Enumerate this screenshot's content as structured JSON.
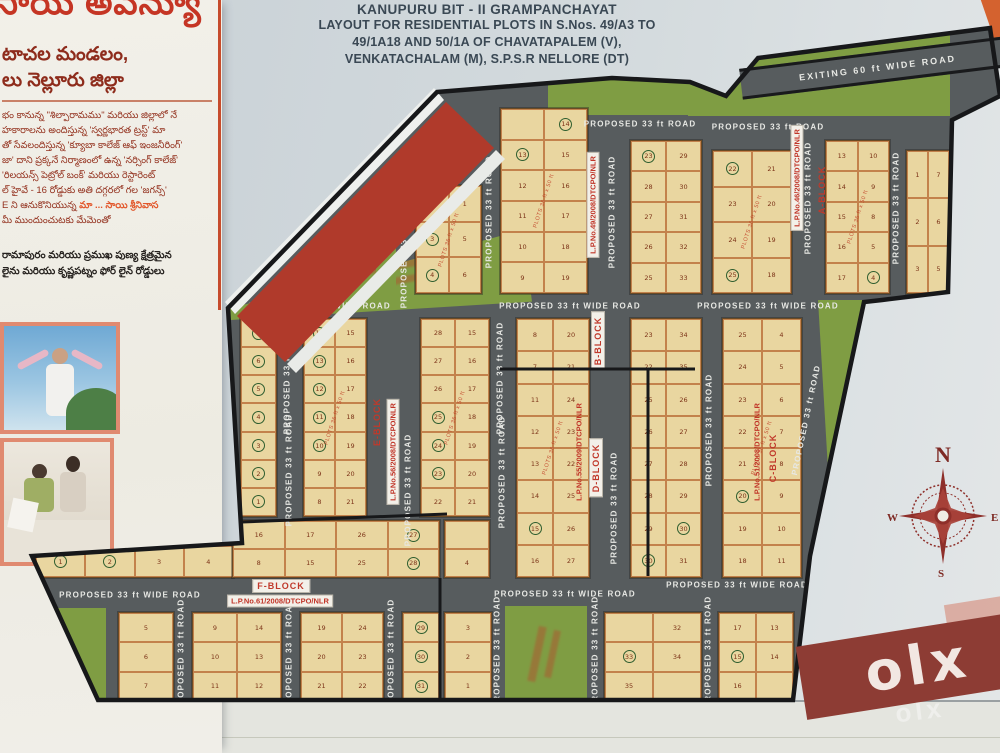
{
  "sidebar": {
    "heading": "సాయి అవెన్యూ",
    "sub_lines": [
      "టాచల మండలం,",
      "లు నెల్లూరు జిల్లా"
    ],
    "paragraph_lines": [
      "భం కానున్న \"శిల్పారామము\" మరియు జిల్లాలో నే",
      "హకారాలను అందిస్తున్న 'స్వర్ణభారత ట్రస్ట్' మా",
      "తో సేవలందిస్తున్న 'క్యూబా కాలేజ్ ఆఫ్ ఇంజనీరింగ్'",
      "జా' దాని ప్రక్కనే నిర్మాణంలో ఉన్న 'నర్సింగ్ కాలేజ్'",
      "'రిలయన్స్ పెట్రోల్ బంక్' మరియు రెస్టారెంట్",
      "ల్ హైవే - 16 రోడ్డుకు అతి దగ్గరలో గల 'జగన్స్'",
      "E ని ఆనుకొనియున్న"
    ],
    "highlight_text": "మా ... సాయి శ్రీనివాస",
    "closing_line": "మీ ముందుంచుటకు మేమెంతో",
    "info_lines": [
      "రామాపురం మరియు ప్రముఖ పుణ్య క్షేత్రమైన",
      "లైను మరియు కృష్ణపట్నం ఫోర్ లైన్ రోడ్డులు"
    ]
  },
  "title": {
    "lines": [
      "KANUPURU BIT - II  GRAMPANCHAYAT",
      "LAYOUT FOR RESIDENTIAL PLOTS IN S.Nos. 49/A3 TO",
      "49/1A18 AND 50/1A OF  CHAVATAPALEM (V),",
      "VENKATACHALAM (M), S.P.S.R NELLORE (DT)"
    ]
  },
  "map": {
    "road_labels": {
      "wide": "PROPOSED 33 ft WIDE ROAD",
      "std": "PROPOSED 33 ft ROAD",
      "exiting": "EXITING  60 ft  WIDE ROAD"
    },
    "plots_size_label": "PLOTS 36 ft x 50 ft",
    "dimension_label": "264'-0\"",
    "block_labels": {
      "a": "A-BLOCK",
      "b": "B-BLOCK",
      "c": "C-BLOCK",
      "d": "D-BLOCK",
      "e": "E-BLOCK",
      "f": "F-BLOCK"
    },
    "lp_numbers": {
      "lp46": "L.P.No.46/2008/DTCPO/NLR",
      "lp49": "L.P.No.49/2008/DTCPO/NLR",
      "lp51": "L.P.No.51/2008/DTCPO/NLR",
      "lp55": "L.P.No.55/2009/DTCPO/NLR",
      "lp56": "L.P.No.56/2008/DTCPO/NLR",
      "lp61": "L.P.No.61/2008/DTCPO/NLR"
    },
    "compass": {
      "n": "N",
      "e": "E",
      "s": "S",
      "w": "W"
    },
    "colors": {
      "road": "#575c5e",
      "plot": "#e9d6a0",
      "park": "#7f9d43",
      "boundary": "#17181a",
      "accent_red": "#c0392b",
      "roof_red": "#b03a2b"
    },
    "blocks": [
      {
        "id": "t1",
        "rows": [
          [
            "2",
            "1"
          ],
          [
            "3",
            "5"
          ],
          [
            "4",
            "6"
          ]
        ],
        "circled": [
          "3",
          "4"
        ]
      },
      {
        "id": "t2",
        "rows": [
          [
            "",
            "14"
          ],
          [
            "13",
            "15"
          ],
          [
            "12",
            "16"
          ],
          [
            "11",
            "17"
          ],
          [
            "10",
            "18"
          ],
          [
            "9",
            "19"
          ]
        ],
        "circled": [
          "13",
          "14"
        ]
      },
      {
        "id": "t3",
        "rows": [
          [
            "23",
            "29"
          ],
          [
            "28",
            "30"
          ],
          [
            "27",
            "31"
          ],
          [
            "26",
            "32"
          ],
          [
            "25",
            "33"
          ]
        ],
        "circled": [
          "23"
        ]
      },
      {
        "id": "a1",
        "rows": [
          [
            "22",
            "21"
          ],
          [
            "23",
            "20"
          ],
          [
            "24",
            "19"
          ],
          [
            "25",
            "18"
          ]
        ],
        "circled": [
          "22",
          "25"
        ]
      },
      {
        "id": "a2",
        "rows": [
          [
            "13",
            "10"
          ],
          [
            "14",
            "9"
          ],
          [
            "15",
            "8"
          ],
          [
            "16",
            "5"
          ],
          [
            "17",
            "4"
          ]
        ],
        "circled": [
          "4"
        ]
      },
      {
        "id": "a3",
        "rows": [
          [
            "1",
            "7"
          ],
          [
            "2",
            "6"
          ],
          [
            "3",
            "5"
          ]
        ],
        "circled": []
      },
      {
        "id": "m0",
        "rows": [
          [
            "7"
          ],
          [
            "6"
          ],
          [
            "5"
          ],
          [
            "4"
          ],
          [
            "3"
          ],
          [
            "2"
          ],
          [
            "1"
          ]
        ],
        "circled": [
          "7",
          "6",
          "5",
          "4",
          "3",
          "2",
          "1"
        ]
      },
      {
        "id": "m1",
        "rows": [
          [
            "14",
            "15"
          ],
          [
            "13",
            "16"
          ],
          [
            "12",
            "17"
          ],
          [
            "11",
            "18"
          ],
          [
            "10",
            "19"
          ],
          [
            "9",
            "20"
          ],
          [
            "8",
            "21"
          ]
        ],
        "circled": [
          "14",
          "13",
          "12",
          "11",
          "10"
        ]
      },
      {
        "id": "m2",
        "rows": [
          [
            "28",
            "15"
          ],
          [
            "27",
            "16"
          ],
          [
            "26",
            "17"
          ],
          [
            "25",
            "18"
          ],
          [
            "24",
            "19"
          ],
          [
            "23",
            "20"
          ],
          [
            "22",
            "21"
          ]
        ],
        "circled": [
          "25",
          "24",
          "23"
        ]
      },
      {
        "id": "m3",
        "rows": [
          [
            "8",
            "20"
          ],
          [
            "7",
            "21"
          ],
          [
            "11",
            "24"
          ],
          [
            "12",
            "23"
          ],
          [
            "13",
            "22"
          ],
          [
            "14",
            "25"
          ],
          [
            "15",
            "26"
          ],
          [
            "16",
            "27"
          ]
        ],
        "circled": [
          "15"
        ]
      },
      {
        "id": "m4",
        "rows": [
          [
            "23",
            "34"
          ],
          [
            "22",
            "35"
          ],
          [
            "25",
            "26"
          ],
          [
            "26",
            "27"
          ],
          [
            "27",
            "28"
          ],
          [
            "28",
            "29"
          ],
          [
            "29",
            "30"
          ],
          [
            "30",
            "31"
          ]
        ],
        "circled": [
          "30"
        ]
      },
      {
        "id": "m5",
        "rows": [
          [
            "25",
            "4"
          ],
          [
            "24",
            "5"
          ],
          [
            "23",
            "6"
          ],
          [
            "22",
            "7"
          ],
          [
            "21",
            "8"
          ],
          [
            "20",
            "9"
          ],
          [
            "19",
            "10"
          ],
          [
            "18",
            "11"
          ]
        ],
        "circled": [
          "20"
        ]
      },
      {
        "id": "f0",
        "rows": [
          [
            "1",
            "2",
            "3",
            "4"
          ]
        ],
        "circled": [
          "1",
          "2"
        ]
      },
      {
        "id": "f1",
        "rows": [
          [
            "16",
            "17",
            "26",
            "27"
          ],
          [
            "8",
            "15",
            "25",
            "28"
          ]
        ],
        "circled": [
          "27",
          "28"
        ]
      },
      {
        "id": "g0",
        "rows": [
          [
            ""
          ],
          [
            "4"
          ]
        ],
        "circled": []
      },
      {
        "id": "g1",
        "rows": [
          [
            "5"
          ],
          [
            "6"
          ],
          [
            "7"
          ]
        ],
        "circled": []
      },
      {
        "id": "g2",
        "rows": [
          [
            "9",
            "14"
          ],
          [
            "10",
            "13"
          ],
          [
            "11",
            "12"
          ]
        ],
        "circled": []
      },
      {
        "id": "g3",
        "rows": [
          [
            "19",
            "24"
          ],
          [
            "20",
            "23"
          ],
          [
            "21",
            "22"
          ]
        ],
        "circled": []
      },
      {
        "id": "g4",
        "rows": [
          [
            "29"
          ],
          [
            "30"
          ],
          [
            "31"
          ]
        ],
        "circled": [
          "29",
          "30",
          "31"
        ]
      },
      {
        "id": "g5",
        "rows": [
          [
            "3"
          ],
          [
            "2"
          ],
          [
            "1"
          ]
        ],
        "circled": []
      },
      {
        "id": "g6",
        "rows": [
          [
            "",
            "32"
          ],
          [
            "33",
            "34"
          ],
          [
            "35",
            ""
          ]
        ],
        "circled": [
          "33"
        ]
      },
      {
        "id": "g7",
        "rows": [
          [
            "17",
            "13"
          ],
          [
            "15",
            "14"
          ],
          [
            "16",
            ""
          ]
        ],
        "circled": [
          "15"
        ]
      }
    ]
  },
  "watermark": {
    "text": "olx"
  }
}
